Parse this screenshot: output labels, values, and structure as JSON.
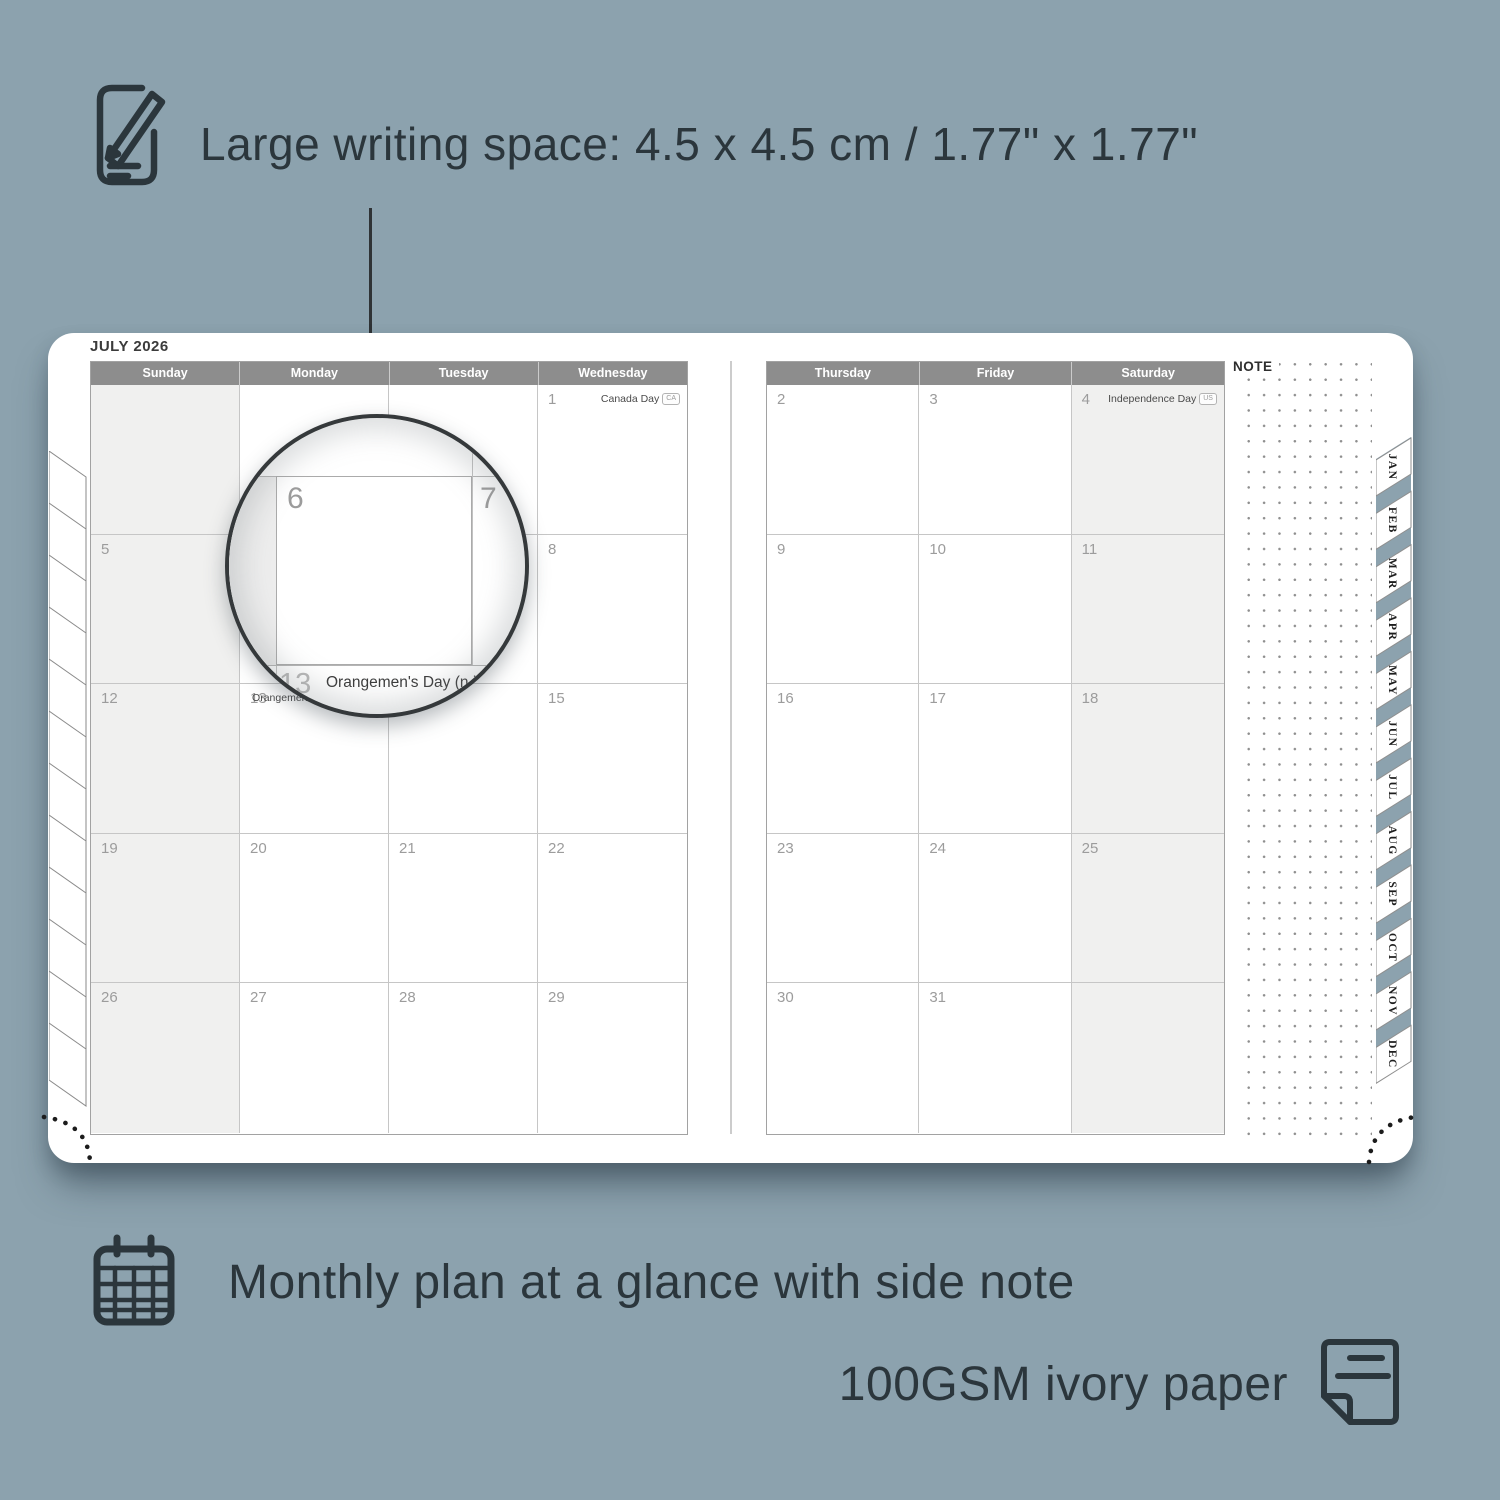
{
  "colors": {
    "background": "#8ca2ae",
    "page": "#ffffff",
    "ink": "#2b363c",
    "header-bg": "#8d8d8d",
    "header-text": "#ffffff",
    "grid-line": "#c6c6c6",
    "day-number": "#9c9c9c",
    "weekend-fill": "#f0f0ef",
    "holiday-text": "#4a4a4a",
    "dot-color": "#8f8f8f",
    "stitch": "#1c1c1c"
  },
  "captions": {
    "writing_space": "Large writing space: 4.5 x 4.5 cm / 1.77\" x 1.77\"",
    "monthly_plan": "Monthly plan at a glance with side note",
    "paper": "100GSM ivory paper"
  },
  "planner": {
    "month_title": "JULY 2026",
    "note_label": "NOTE",
    "month_tabs": [
      "JAN",
      "FEB",
      "MAR",
      "APR",
      "MAY",
      "JUN",
      "JUL",
      "AUG",
      "SEP",
      "OCT",
      "NOV",
      "DEC"
    ],
    "left_page": {
      "headers": [
        "Sunday",
        "Monday",
        "Tuesday",
        "Wednesday"
      ],
      "weekend_col": 0,
      "rows": [
        [
          {
            "day": ""
          },
          {
            "day": ""
          },
          {
            "day": ""
          },
          {
            "day": "1",
            "holiday": "Canada Day",
            "badge": "CA"
          }
        ],
        [
          {
            "day": "5"
          },
          {
            "day": "6"
          },
          {
            "day": "7"
          },
          {
            "day": "8"
          }
        ],
        [
          {
            "day": "12"
          },
          {
            "day": "13",
            "holiday": "Orangemen's Day (n.i.)",
            "badge": "UK"
          },
          {
            "day": "14"
          },
          {
            "day": "15"
          }
        ],
        [
          {
            "day": "19"
          },
          {
            "day": "20"
          },
          {
            "day": "21"
          },
          {
            "day": "22"
          }
        ],
        [
          {
            "day": "26"
          },
          {
            "day": "27"
          },
          {
            "day": "28"
          },
          {
            "day": "29"
          }
        ]
      ]
    },
    "right_page": {
      "headers": [
        "Thursday",
        "Friday",
        "Saturday"
      ],
      "weekend_col": 2,
      "rows": [
        [
          {
            "day": "2"
          },
          {
            "day": "3"
          },
          {
            "day": "4",
            "holiday": "Independence Day",
            "badge": "US"
          }
        ],
        [
          {
            "day": "9"
          },
          {
            "day": "10"
          },
          {
            "day": "11"
          }
        ],
        [
          {
            "day": "16"
          },
          {
            "day": "17"
          },
          {
            "day": "18"
          }
        ],
        [
          {
            "day": "23"
          },
          {
            "day": "24"
          },
          {
            "day": "25"
          }
        ],
        [
          {
            "day": "30"
          },
          {
            "day": "31"
          },
          {
            "day": ""
          }
        ]
      ]
    }
  },
  "magnifier": {
    "main_day": "6",
    "next_day": "7",
    "below_day": "13",
    "holiday": "Orangemen's Day (n.i.)",
    "badge": "UK"
  }
}
